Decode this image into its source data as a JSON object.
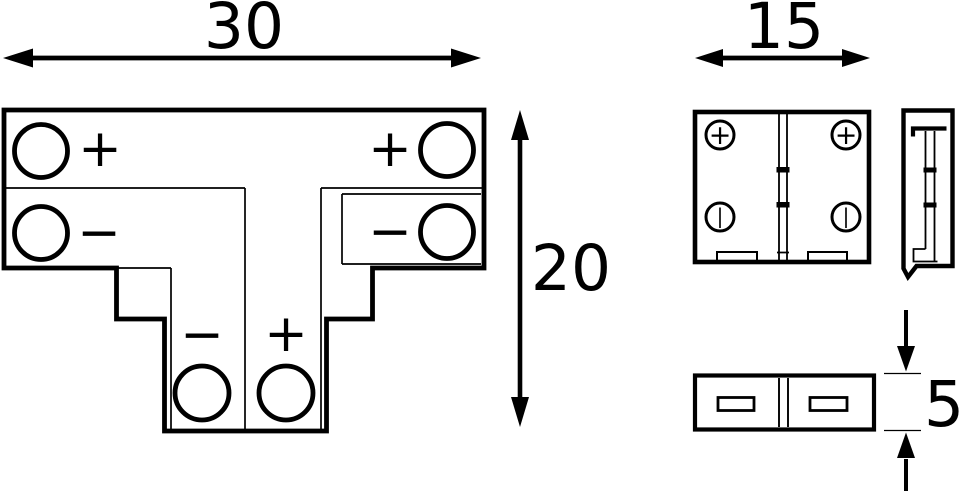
{
  "drawing": {
    "background_color": "#ffffff",
    "ink_color": "#000000",
    "description": "Technical dimension drawing of a T-shaped LED strip connector: top view (T shape), front view, side profile view and bottom view"
  },
  "dimensions": {
    "width": {
      "value": "30"
    },
    "height": {
      "value": "20"
    },
    "front_width": {
      "value": "15"
    },
    "thickness": {
      "value": "5"
    }
  },
  "views": {
    "top_view": {
      "name": "T-connector top view",
      "contacts": [
        {
          "position": "top-left",
          "sign": "+"
        },
        {
          "position": "top-right",
          "sign": "+"
        },
        {
          "position": "middle-left",
          "sign": "−"
        },
        {
          "position": "middle-right",
          "sign": "−"
        },
        {
          "position": "stem-left",
          "sign": "−"
        },
        {
          "position": "stem-right",
          "sign": "+"
        }
      ]
    },
    "front_view": {
      "name": "connector front view",
      "contacts": [
        {
          "position": "top-left",
          "mark": "+"
        },
        {
          "position": "top-right",
          "mark": "+"
        },
        {
          "position": "bottom-left",
          "mark": "|"
        },
        {
          "position": "bottom-right",
          "mark": "|"
        }
      ]
    },
    "side_view": {
      "name": "connector side profile view"
    },
    "bottom_view": {
      "name": "connector bottom view"
    }
  }
}
